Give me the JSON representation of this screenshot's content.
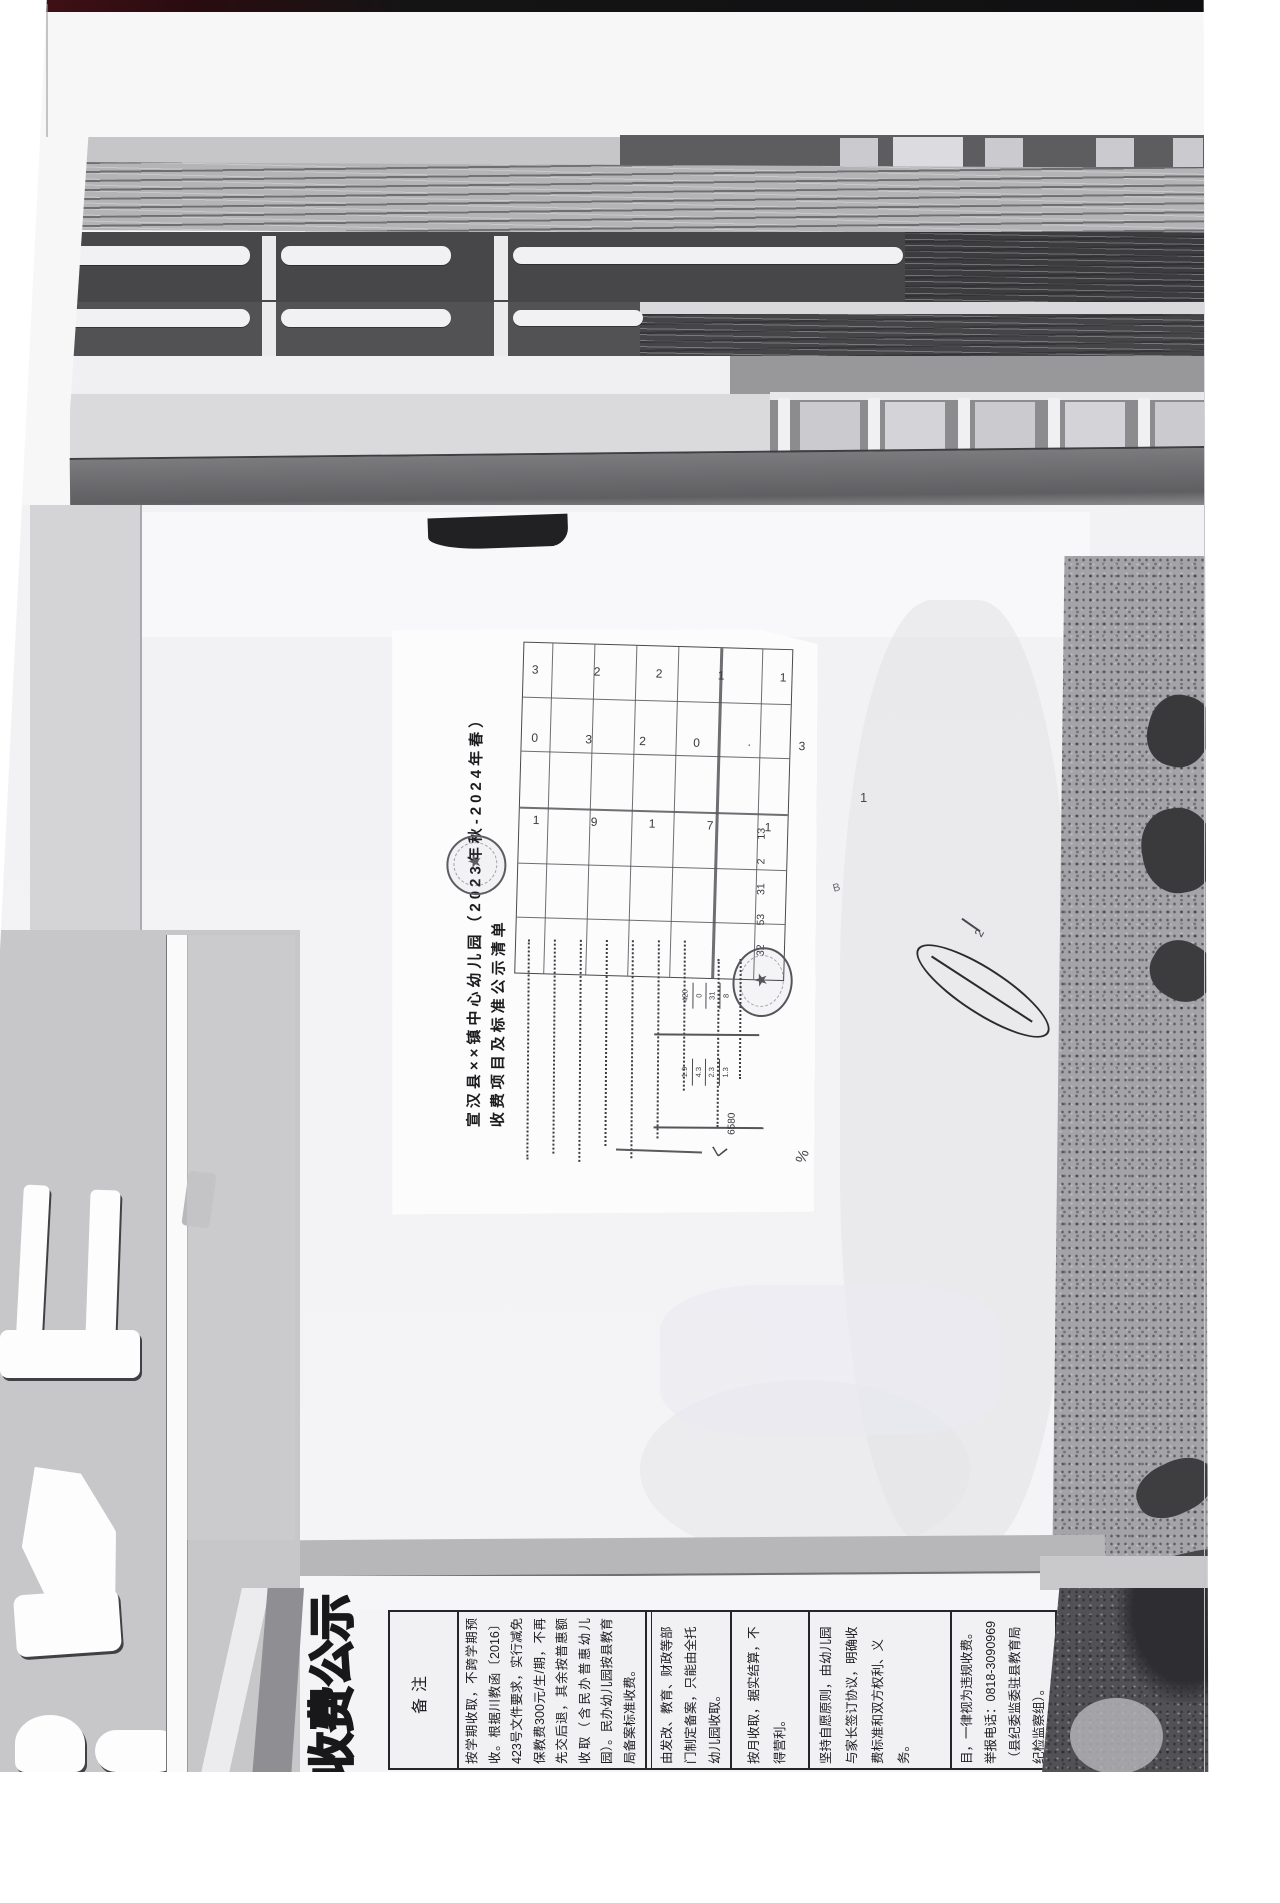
{
  "sign": {
    "ornate_title": "收费公示"
  },
  "notes_table": {
    "header_label": "备注",
    "hotline": "0818-3090969",
    "cells": [
      "按学期收取，不跨学期预收。根据川教函〔2016〕423号文件要求，实行减免保教费300元/生/期，不再先交后退，其余按普惠额收取（含民办普惠幼儿园）。民办幼儿园按县教育局备案标准收费。",
      "由发改、教育、财政等部门制定备案，只能由全托幼儿园收取。",
      "按月收取，据实结算，不得营利。",
      "坚持自愿原则，由幼儿园与家长签订协议，明确收费标准和双方权利、义务。",
      "目，一律视为违规收费。举报电话：0818-3090969（县纪委监委驻县教育局纪检监察组）。"
    ]
  },
  "document": {
    "title_line1": "宣汉县××镇中心幼儿园（2023年秋-2024年春）",
    "title_line2": "收费项目及标准公示清单",
    "table_marks_row1": "3 2 2 1 1 3 2",
    "table_marks_row2": "0 3 2 0 · 3 · 3",
    "table_marks_row3": "1 9 1 7 1 3 1",
    "table_totals": "32 53 31 2 13",
    "figures_group1": [
      "420",
      "0",
      "31",
      "8"
    ],
    "figures_group2": [
      "1.9",
      "4.3",
      "2.3",
      "1.3"
    ],
    "figures_total": "6580",
    "seal_glyph": "★",
    "scribbles": {
      "m1": "く",
      "m2": "%",
      "m3": "1",
      "m4": "2",
      "m5": "B"
    }
  },
  "colors": {
    "top_strip_red": "#3f1016",
    "seal_gray": "#5c5c62"
  }
}
